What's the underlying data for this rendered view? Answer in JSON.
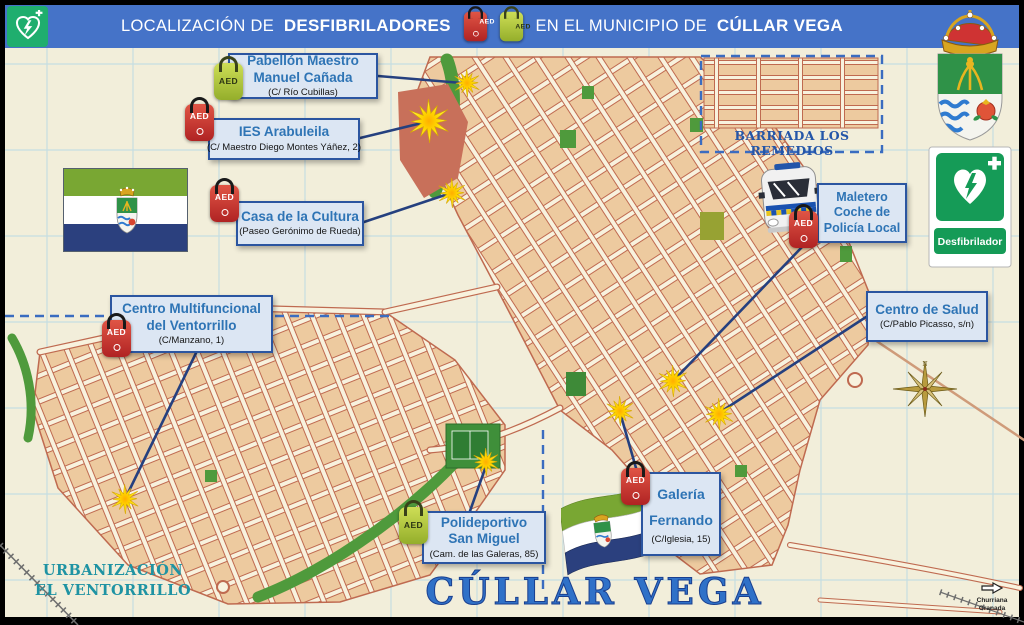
{
  "header": {
    "title_part1": "LOCALIZACIÓN DE",
    "title_bold1": "DESFIBRILADORES",
    "title_part2": "EN EL MUNICIPIO DE",
    "title_bold2": "CÚLLAR VEGA"
  },
  "map_labels": {
    "barriada": "BARRIADA LOS REMEDIOS",
    "urbanizacion": [
      "URBANIZACIÓN",
      "EL VENTORRILLO"
    ],
    "town_title": "CÚLLAR VEGA",
    "direction_sign": [
      "Churriana",
      "Granada"
    ]
  },
  "signs": {
    "defibrillator_sign_label": "Desfibrilador",
    "aed_device_label": "AED"
  },
  "locations": [
    {
      "id": "pabellon-maestro-manuel-canada",
      "name_lines": [
        "Pabellón Maestro",
        "Manuel Cañada"
      ],
      "address": "(C/ Río Cubillas)",
      "aed_color": "green",
      "box": {
        "x": 228,
        "y": 53,
        "w": 150,
        "h": 46
      },
      "aed": {
        "x": 214,
        "y": 63
      },
      "burst": {
        "x": 467,
        "y": 83,
        "r": 14
      },
      "line": [
        378,
        76,
        462,
        83
      ]
    },
    {
      "id": "ies-arabuleila",
      "name_lines": [
        "IES Arabuleila"
      ],
      "address": "(C/ Maestro Diego Montes Yáñez, 2)",
      "aed_color": "red",
      "box": {
        "x": 208,
        "y": 118,
        "w": 152,
        "h": 42
      },
      "aed": {
        "x": 185,
        "y": 104
      },
      "burst": {
        "x": 429,
        "y": 121,
        "r": 22
      },
      "line": [
        360,
        138,
        426,
        122
      ]
    },
    {
      "id": "casa-de-la-cultura",
      "name_lines": [
        "Casa de la Cultura"
      ],
      "address": "(Paseo Gerónimo de Rueda)",
      "aed_color": "red",
      "box": {
        "x": 236,
        "y": 201,
        "w": 128,
        "h": 45
      },
      "aed": {
        "x": 210,
        "y": 185
      },
      "burst": {
        "x": 452,
        "y": 193,
        "r": 15
      },
      "line": [
        364,
        222,
        448,
        194
      ]
    },
    {
      "id": "centro-multifuncional-del-ventorrillo",
      "name_lines": [
        "Centro Multifuncional",
        "del Ventorrillo"
      ],
      "address": "(C/Manzano, 1)",
      "aed_color": "red",
      "box": {
        "x": 110,
        "y": 295,
        "w": 163,
        "h": 58
      },
      "aed": {
        "x": 102,
        "y": 320
      },
      "burst": {
        "x": 125,
        "y": 499,
        "r": 15
      },
      "line": [
        196,
        353,
        127,
        495
      ]
    },
    {
      "id": "maletero-coche-policia-local",
      "name_lines": [
        "Maletero",
        "Coche de",
        "Policía Local"
      ],
      "address": "",
      "aed_color": "red",
      "compact": true,
      "box": {
        "x": 817,
        "y": 183,
        "w": 90,
        "h": 60
      },
      "aed": {
        "x": 789,
        "y": 211
      },
      "burst": {
        "x": 673,
        "y": 381,
        "r": 16
      },
      "line": [
        803,
        246,
        676,
        378
      ]
    },
    {
      "id": "centro-de-salud",
      "name_lines": [
        "Centro de Salud"
      ],
      "address": "(C/Pablo Picasso, s/n)",
      "aed_color": null,
      "box": {
        "x": 866,
        "y": 291,
        "w": 122,
        "h": 51
      },
      "burst": {
        "x": 719,
        "y": 414,
        "r": 16
      },
      "line": [
        866,
        317,
        722,
        411
      ]
    },
    {
      "id": "galeria-fernando",
      "name_lines": [
        "Galería",
        "Fernando"
      ],
      "address": "(C/Iglesia, 15)",
      "aed_color": "red",
      "tall": true,
      "box": {
        "x": 641,
        "y": 472,
        "w": 80,
        "h": 84
      },
      "aed": {
        "x": 621,
        "y": 468
      },
      "burst": {
        "x": 620,
        "y": 411,
        "r": 15
      },
      "line": [
        636,
        468,
        621,
        416
      ]
    },
    {
      "id": "polideportivo-san-miguel",
      "name_lines": [
        "Polideportivo",
        "San Miguel"
      ],
      "address": "(Cam. de las Galeras, 85)",
      "aed_color": "green",
      "box": {
        "x": 422,
        "y": 511,
        "w": 124,
        "h": 53
      },
      "aed": {
        "x": 399,
        "y": 507
      },
      "burst": {
        "x": 486,
        "y": 462,
        "r": 14
      },
      "line": [
        470,
        511,
        486,
        466
      ]
    }
  ],
  "colors": {
    "header_bg": "#4573c8",
    "callout_bg": "#dce6f3",
    "callout_border": "#2b55a0",
    "callout_text": "#2e74b5",
    "map_background": "#f2eeda",
    "block_tan": "#edca9f",
    "street_casing": "#bf6a50",
    "park_green": "#4f9a3c",
    "burst_yellow": "#ffe000",
    "sign_green": "#159b57",
    "flag_green": "#79a733",
    "flag_navy": "#2b407e",
    "boundary_dashed_blue": "#3a6cc0"
  }
}
